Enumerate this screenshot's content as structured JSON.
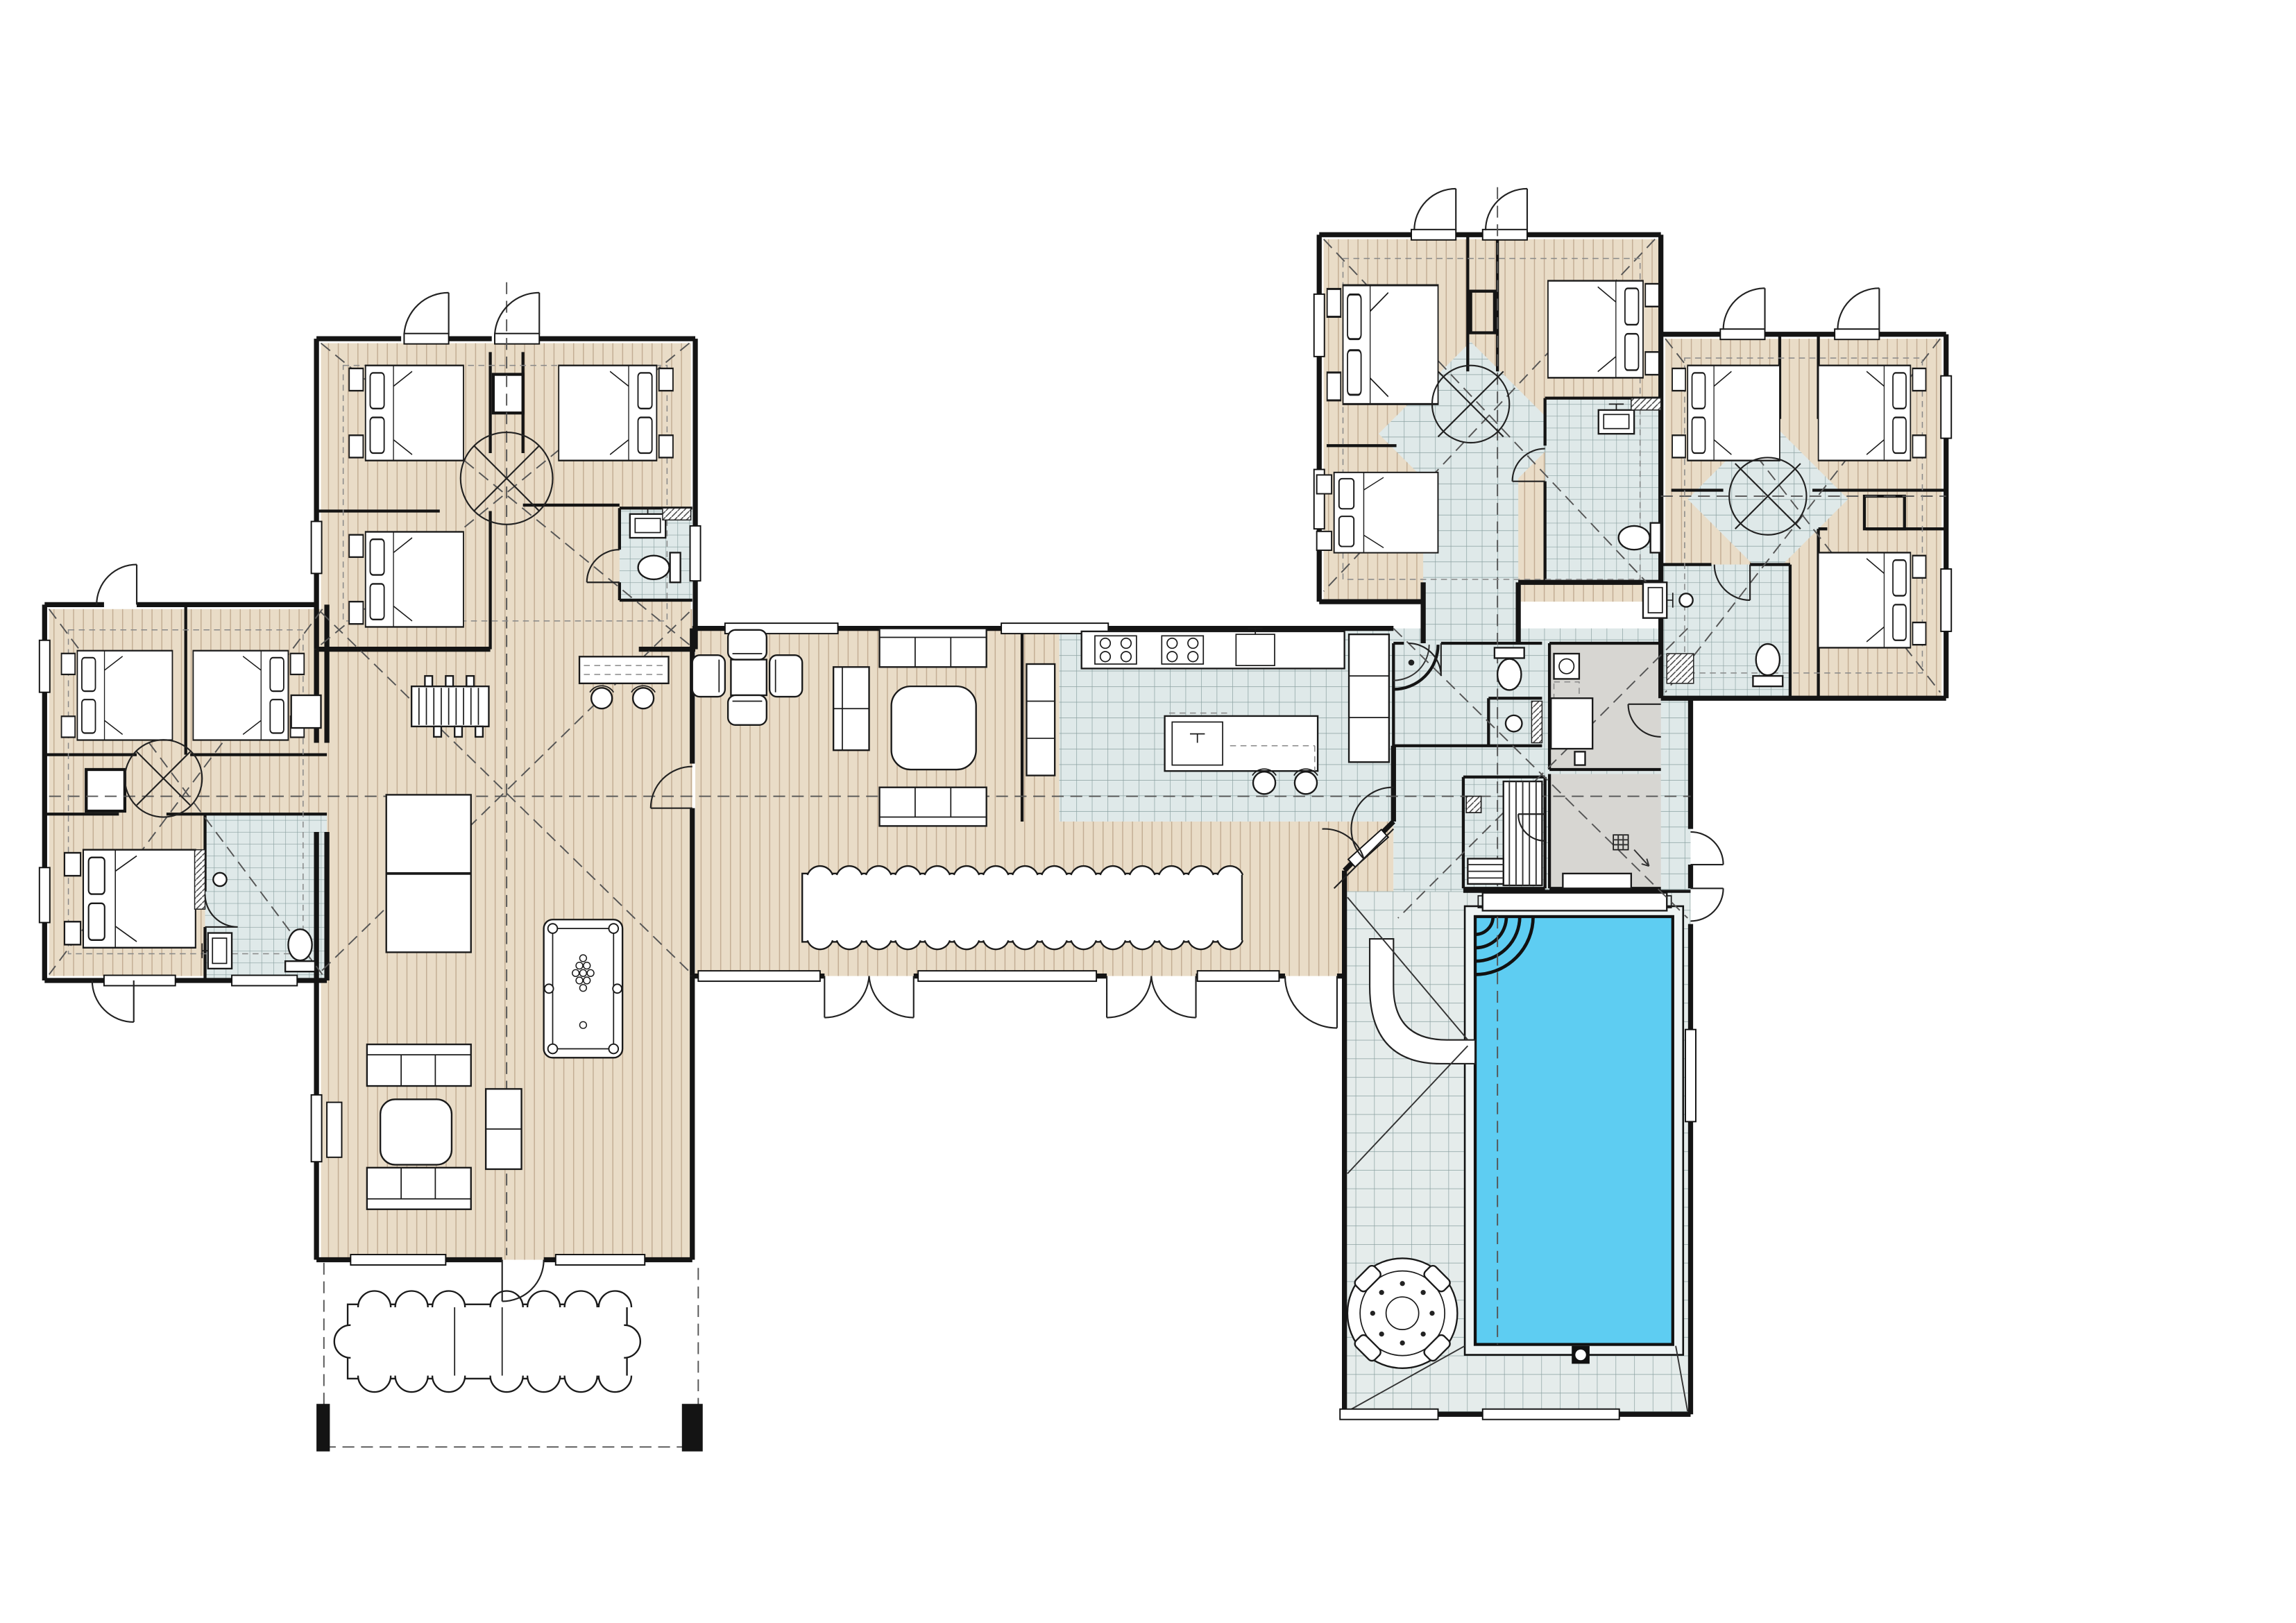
{
  "colors": {
    "paper": "#ffffff",
    "wall": "#141414",
    "wood-base": "#e9dcc7",
    "wood-stripe": "#a3866a",
    "tile-base": "#dfe9e9",
    "tile-line": "#8aa0a0",
    "deck-base": "#e5eceb",
    "grey-room": "#d7d6d2",
    "pool-water": "#5ecdf2",
    "pool-rim": "#eef4f4",
    "dash": "#555555"
  },
  "plan": {
    "type": "architectural-floor-plan",
    "storey": "ground-floor",
    "bedroom_count": 12,
    "bathroom_count": 6,
    "features": [
      "pool",
      "water-slide",
      "hot-tub",
      "sauna",
      "billiard-table",
      "table-tennis",
      "indoor-dining-table",
      "outdoor-dining-table",
      "kitchen-island",
      "laundry",
      "patio"
    ]
  }
}
